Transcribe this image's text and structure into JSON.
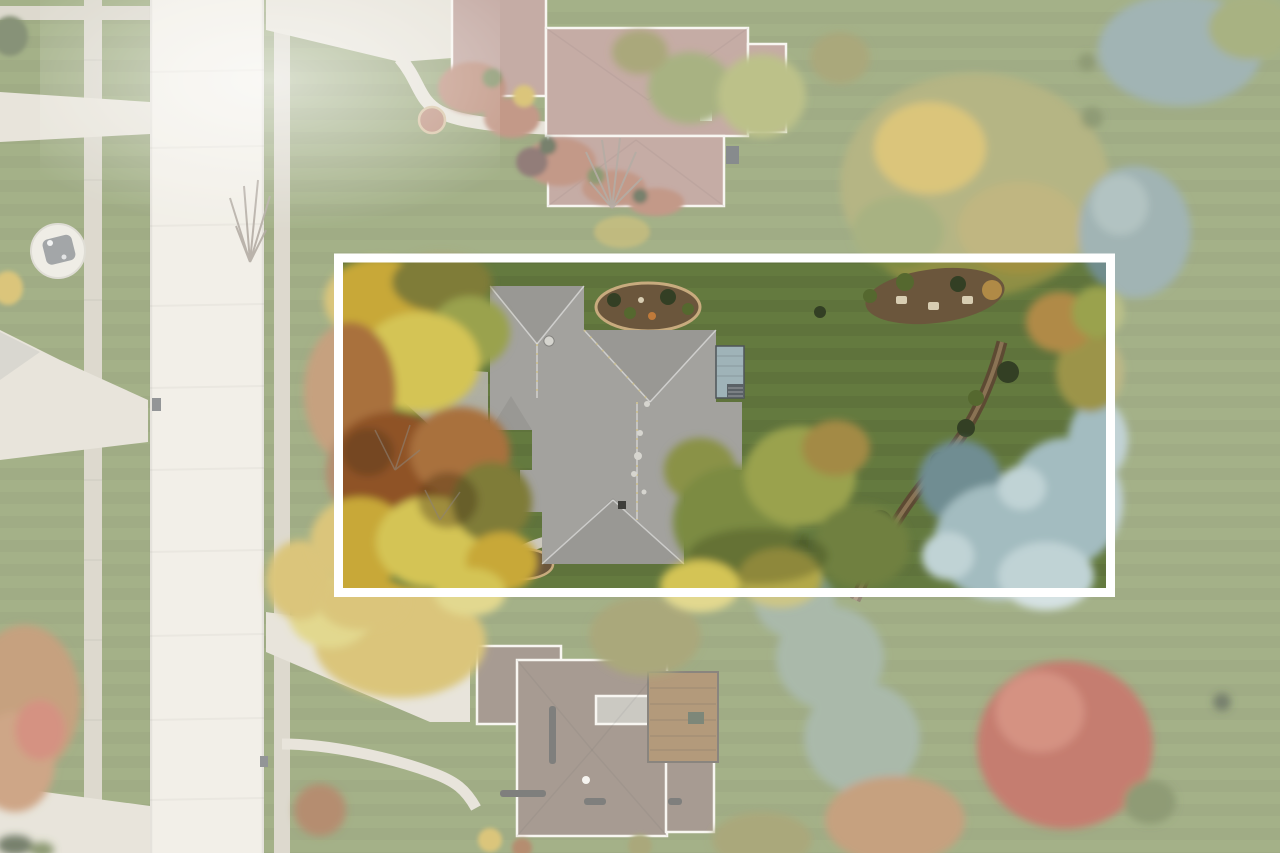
{
  "scene": {
    "type": "aerial-drone-photograph",
    "subject": "overhead view of a suburban residential lot outlined with a white property-boundary rectangle",
    "effect": "area outside the boundary is whitewashed and desaturated; lot interior is full color",
    "season_cues": "autumn foliage: gold, orange, rust, red maple and blue-spruce trees; striped mowed lawn",
    "visible_text": "none"
  },
  "boundary": {
    "x": 338.5,
    "y": 258,
    "width": 772,
    "height": 334.5,
    "stroke_width": 9,
    "color": "#ffffff",
    "outside_fade_opacity": 0.34,
    "lot_tint": "rgba(15,45,5,0.16)"
  },
  "features": {
    "street": "vertical concrete street on left with curbs, seams and sidewalks",
    "left_sidewalk": "narrow sidewalk strip west of the street",
    "round_feature": "small circular paved feature with grey object on left lawn",
    "neighbor_house_top": "mauve/tan hip-roof house at top with curved front walk, red mulch beds and driveway",
    "subject_house": "large grey hip-roof house inside the boundary with rear deck, roof vents and stone-edged planting beds",
    "subject_trees_left": "dense autumn canopy (gold/orange/rust) on west side of lot",
    "subject_trees_right": "green-gold deciduous trees and silver blue-spruce cluster along east landscape bed",
    "neighbor_house_bottom": "grey-brown roof house at bottom with wood deck, skylights, driveway and curved walk",
    "faded_trees": "washed-out autumn trees, conifers and a red maple outside the boundary"
  },
  "colors": {
    "lawn": "#75894b",
    "street": "#ebe7dc",
    "sidewalk": "#cbc6b5",
    "driveway": "#dcd7c8",
    "concrete_dark": "#b7b5ad",
    "main_roof": "#a3a29e",
    "roof_ridge": "#d6d5cf",
    "roof_vent_dark": "#3e3e3a",
    "top_house_roof": "#a88177",
    "bottom_house_roof": "#7a685a",
    "flat_roof": "#b0ada3",
    "gutter_white": "#f4f1ea",
    "deck_wood": "#8c6738",
    "deck_grey": "#9fb3b8",
    "railing_dark": "#4e5458",
    "mulch": "#6b563c",
    "mulch_red": "#a4654c",
    "mulch_edge": "#5d4a33",
    "stone_edge": "#c8ab7e",
    "shrub_dark": "#333f24",
    "shrub_green": "#55682f",
    "autumn_gold": "#c8a838",
    "autumn_yellow": "#d4c455",
    "autumn_orange": "#a9713c",
    "autumn_rust": "#8f5327",
    "autumn_olive": "#7f7b38",
    "tree_green": "#7c8b42",
    "tree_green_light": "#9aa24e",
    "spruce_blue": "#a3bcc0",
    "spruce_blue_light": "#c0d3d5",
    "spruce_blue_dark": "#6f8d92",
    "conifer_faded": "#718d8d",
    "conifer_green": "#7e957f",
    "red_tree": "#a83a28",
    "red_tree_light": "#bf5a42",
    "bare_branch": "#8d8276",
    "dark_object": "#4a4f52",
    "mailbox": "#5c5f61",
    "water_feature": "#74797c",
    "fade_white": "#ffffff"
  }
}
